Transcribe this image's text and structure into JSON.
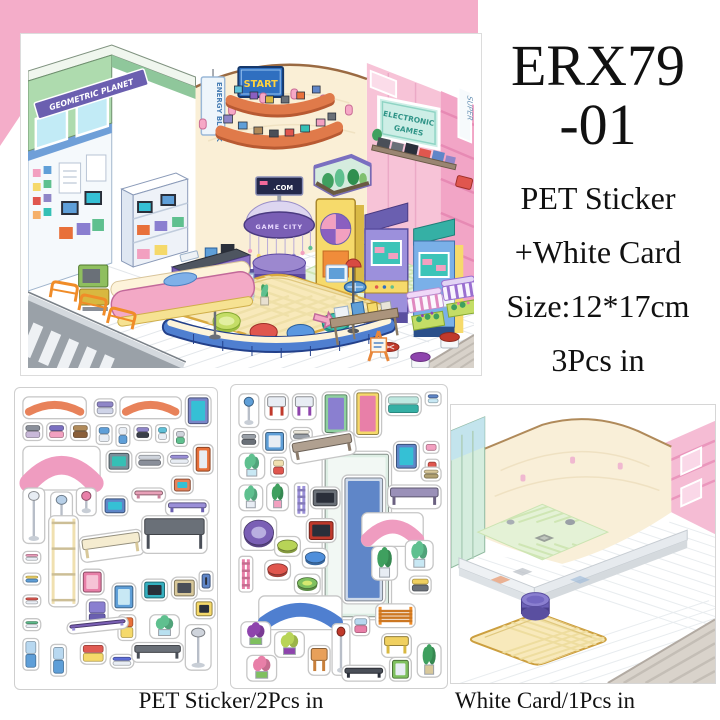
{
  "product": {
    "code_line1": "ERX79",
    "code_line2": "-01",
    "desc_line1": "PET Sticker",
    "desc_line2": "+White Card",
    "desc_line3": "Size:12*17cm",
    "desc_line4": "3Pcs in"
  },
  "captions": {
    "sticker_sheets": "PET Sticker/2Pcs in",
    "white_card": "White Card/1Pcs in"
  },
  "scene_signs": {
    "geometric_planet": "GEOMETRIC PLANET",
    "energy_block": "ENERGY BLOCK",
    "start": "START",
    "electronic": "ELECTRONIC",
    "games": "GAMES",
    "super": "SUPER",
    "game_city": "GAME CITY",
    "com": ".COM"
  },
  "colors": {
    "pink_background": "#f4adc9",
    "wall_cream": "#faefd6",
    "wall_pink": "#f7c3d7",
    "building_green": "#aedbae",
    "shelf_orange": "#e07a4a",
    "carousel_purple": "#7a5fb5",
    "rug_yellow": "#f8e9ba",
    "bench_blue": "#4f7fd0",
    "street_gray": "#9aa1a8"
  },
  "sheet1": {
    "stickers": [
      {
        "n": "curved-shelf",
        "s": "arc",
        "x": 8,
        "y": 8,
        "w": 64,
        "h": 22,
        "c": [
          "#e8825a"
        ]
      },
      {
        "n": "gadget-purple",
        "s": "box",
        "x": 80,
        "y": 10,
        "w": 22,
        "h": 18,
        "c": [
          "#8f86c8",
          "#cfd4e8"
        ]
      },
      {
        "n": "curved-shelf",
        "s": "arc",
        "x": 106,
        "y": 8,
        "w": 62,
        "h": 22,
        "c": [
          "#e8825a"
        ]
      },
      {
        "n": "tv-cart",
        "s": "tv",
        "x": 172,
        "y": 6,
        "w": 26,
        "h": 32,
        "c": [
          "#7a86c8",
          "#35c0d5"
        ]
      },
      {
        "n": "headphones",
        "s": "box",
        "x": 8,
        "y": 34,
        "w": 20,
        "h": 18,
        "c": [
          "#8a8f9a",
          "#c8b8d8"
        ]
      },
      {
        "n": "robot-toy",
        "s": "box",
        "x": 32,
        "y": 34,
        "w": 20,
        "h": 18,
        "c": [
          "#7a6fc0",
          "#f2a0c0"
        ]
      },
      {
        "n": "camera-brown",
        "s": "box",
        "x": 56,
        "y": 34,
        "w": 20,
        "h": 18,
        "c": [
          "#b08a5a",
          "#8a5f3a"
        ]
      },
      {
        "n": "handheld-console",
        "s": "box",
        "x": 82,
        "y": 36,
        "w": 16,
        "h": 20,
        "c": [
          "#5f9fd8",
          "#e8edf4"
        ]
      },
      {
        "n": "flip-phone",
        "s": "box",
        "x": 102,
        "y": 36,
        "w": 14,
        "h": 22,
        "c": [
          "#e8edf4",
          "#5f9fd8"
        ]
      },
      {
        "n": "camera-purple",
        "s": "box",
        "x": 120,
        "y": 36,
        "w": 18,
        "h": 16,
        "c": [
          "#8f86c8",
          "#3a3f4a"
        ]
      },
      {
        "n": "mp3-player",
        "s": "box",
        "x": 142,
        "y": 36,
        "w": 14,
        "h": 18,
        "c": [
          "#5fc0d8",
          "#e8edf4"
        ]
      },
      {
        "n": "gameboy",
        "s": "box",
        "x": 160,
        "y": 40,
        "w": 14,
        "h": 18,
        "c": [
          "#cfd4dc",
          "#5fc08f"
        ]
      },
      {
        "n": "pink-counter",
        "s": "arc",
        "x": 8,
        "y": 58,
        "w": 78,
        "h": 44,
        "c": [
          "#ef9cc0"
        ]
      },
      {
        "n": "game-console",
        "s": "tv",
        "x": 92,
        "y": 62,
        "w": 26,
        "h": 22,
        "c": [
          "#7a8f9a",
          "#35c0b5"
        ]
      },
      {
        "n": "keyboard",
        "s": "box",
        "x": 122,
        "y": 64,
        "w": 28,
        "h": 16,
        "c": [
          "#cfd4dc",
          "#8a8f9a"
        ]
      },
      {
        "n": "gamepad",
        "s": "box",
        "x": 154,
        "y": 64,
        "w": 24,
        "h": 14,
        "c": [
          "#9a8fd8",
          "#e8edf4"
        ]
      },
      {
        "n": "vending-unit",
        "s": "tv",
        "x": 180,
        "y": 56,
        "w": 20,
        "h": 30,
        "c": [
          "#e8703a",
          "#e8edf4"
        ]
      },
      {
        "n": "floor-lamp",
        "s": "lamp",
        "x": 8,
        "y": 100,
        "w": 22,
        "h": 56,
        "c": [
          "#e8edf4"
        ]
      },
      {
        "n": "disco-lamp",
        "s": "lamp",
        "x": 36,
        "y": 104,
        "w": 22,
        "h": 40,
        "c": [
          "#b8d0e8"
        ]
      },
      {
        "n": "mushroom-lamp",
        "s": "lamp",
        "x": 62,
        "y": 100,
        "w": 20,
        "h": 28,
        "c": [
          "#e87fa8"
        ]
      },
      {
        "n": "monitor-blue",
        "s": "tv",
        "x": 88,
        "y": 108,
        "w": 26,
        "h": 20,
        "c": [
          "#5f86c8",
          "#35c0d5"
        ]
      },
      {
        "n": "wall-shelf-pink",
        "s": "table",
        "x": 118,
        "y": 100,
        "w": 34,
        "h": 14,
        "c": [
          "#e8a0b8",
          "#c87f9a"
        ]
      },
      {
        "n": "monitor-orange",
        "s": "tv",
        "x": 158,
        "y": 88,
        "w": 22,
        "h": 18,
        "c": [
          "#e8825a",
          "#35c0d5"
        ]
      },
      {
        "n": "purple-shelf-bar",
        "s": "table",
        "x": 152,
        "y": 112,
        "w": 44,
        "h": 16,
        "c": [
          "#9a8fd8",
          "#6a5fb0"
        ]
      },
      {
        "n": "price-tag",
        "s": "box",
        "x": 8,
        "y": 164,
        "w": 18,
        "h": 12,
        "c": [
          "#f2a0c0",
          "#e8edf4"
        ]
      },
      {
        "n": "price-tag",
        "s": "box",
        "x": 8,
        "y": 186,
        "w": 18,
        "h": 12,
        "c": [
          "#f5d96a",
          "#5f9fd8"
        ]
      },
      {
        "n": "price-tag",
        "s": "box",
        "x": 8,
        "y": 208,
        "w": 18,
        "h": 12,
        "c": [
          "#e05a52",
          "#e8edf4"
        ]
      },
      {
        "n": "price-tag",
        "s": "box",
        "x": 8,
        "y": 232,
        "w": 18,
        "h": 12,
        "c": [
          "#5fc08f",
          "#e8edf4"
        ]
      },
      {
        "n": "ladder-shelf",
        "s": "ladder",
        "x": 34,
        "y": 128,
        "w": 30,
        "h": 92,
        "c": [
          "#f0e0b0"
        ]
      },
      {
        "n": "bench-cream",
        "s": "table",
        "x": 64,
        "y": 150,
        "w": 64,
        "h": 26,
        "c": [
          "#f5ecd0",
          "#d8c89a"
        ],
        "r": -8
      },
      {
        "n": "gray-table",
        "s": "table",
        "x": 128,
        "y": 128,
        "w": 66,
        "h": 38,
        "c": [
          "#6a7078",
          "#4a4f58"
        ]
      },
      {
        "n": "mini-fridge-pink",
        "s": "tv",
        "x": 66,
        "y": 182,
        "w": 24,
        "h": 26,
        "c": [
          "#e87fa8",
          "#f6c3d6"
        ]
      },
      {
        "n": "cabinet-purple",
        "s": "box",
        "x": 72,
        "y": 212,
        "w": 22,
        "h": 30,
        "c": [
          "#8a7fd0",
          "#6a5fb0"
        ]
      },
      {
        "n": "cooler-blue",
        "s": "tv",
        "x": 98,
        "y": 196,
        "w": 24,
        "h": 28,
        "c": [
          "#5f9fd8",
          "#c8e8f4"
        ]
      },
      {
        "n": "locker-orange",
        "s": "box",
        "x": 104,
        "y": 228,
        "w": 18,
        "h": 26,
        "c": [
          "#e8703a",
          "#f5d96a"
        ]
      },
      {
        "n": "tv-teal",
        "s": "tv",
        "x": 128,
        "y": 192,
        "w": 26,
        "h": 22,
        "c": [
          "#35b0c0",
          "#2a2f3a"
        ]
      },
      {
        "n": "console-beige",
        "s": "tv",
        "x": 158,
        "y": 190,
        "w": 26,
        "h": 22,
        "c": [
          "#d8c89a",
          "#4a4f58"
        ]
      },
      {
        "n": "tv-blue-small",
        "s": "tv",
        "x": 186,
        "y": 184,
        "w": 14,
        "h": 20,
        "c": [
          "#5f86c8",
          "#2a2f3a"
        ]
      },
      {
        "n": "tv-yellow",
        "s": "tv",
        "x": 180,
        "y": 212,
        "w": 22,
        "h": 20,
        "c": [
          "#f5d96a",
          "#2a2f3a"
        ]
      },
      {
        "n": "sign-blue",
        "s": "box",
        "x": 8,
        "y": 252,
        "w": 16,
        "h": 32,
        "c": [
          "#b8d8f0",
          "#5f9fd8"
        ]
      },
      {
        "n": "sign-blue",
        "s": "box",
        "x": 36,
        "y": 258,
        "w": 16,
        "h": 32,
        "c": [
          "#b8d8f0",
          "#5f9fd8"
        ]
      },
      {
        "n": "planet-sign",
        "s": "table",
        "x": 52,
        "y": 236,
        "w": 62,
        "h": 12,
        "c": [
          "#7a5fb5",
          "#9a8fd8"
        ],
        "r": -6
      },
      {
        "n": "arcade-controls",
        "s": "box",
        "x": 66,
        "y": 256,
        "w": 26,
        "h": 22,
        "c": [
          "#e05a52",
          "#f5d96a"
        ]
      },
      {
        "n": "gamepad-blue",
        "s": "box",
        "x": 96,
        "y": 268,
        "w": 24,
        "h": 14,
        "c": [
          "#5f6fd8",
          "#e8edf4"
        ]
      },
      {
        "n": "media-shelf",
        "s": "table",
        "x": 118,
        "y": 256,
        "w": 52,
        "h": 20,
        "c": [
          "#6a7078",
          "#4a4f58"
        ]
      },
      {
        "n": "aquarium-small",
        "s": "plant",
        "x": 136,
        "y": 228,
        "w": 30,
        "h": 24,
        "c": [
          "#5fc08f",
          "#b8e0f0"
        ]
      },
      {
        "n": "monitor-stand",
        "s": "lamp",
        "x": 172,
        "y": 238,
        "w": 26,
        "h": 46,
        "c": [
          "#cfd4dc"
        ]
      }
    ]
  },
  "sheet2": {
    "stickers": [
      {
        "n": "glass-wall-panel",
        "s": "tv",
        "x": 92,
        "y": 66,
        "w": 70,
        "h": 170,
        "c": [
          "#ddeee4",
          "#f2f8f4"
        ]
      },
      {
        "n": "display-rack",
        "s": "tv",
        "x": 112,
        "y": 90,
        "w": 44,
        "h": 130,
        "c": [
          "#cdd9ea",
          "#5f86c8"
        ]
      },
      {
        "n": "stool-blue",
        "s": "lamp",
        "x": 8,
        "y": 8,
        "w": 20,
        "h": 34,
        "c": [
          "#5f9fd8"
        ]
      },
      {
        "n": "stool-red",
        "s": "table",
        "x": 34,
        "y": 8,
        "w": 24,
        "h": 26,
        "c": [
          "#e8edf4",
          "#c0392b"
        ]
      },
      {
        "n": "stool-purple",
        "s": "table",
        "x": 62,
        "y": 8,
        "w": 24,
        "h": 26,
        "c": [
          "#e8edf4",
          "#8e44ad"
        ]
      },
      {
        "n": "arcade-green",
        "s": "tv",
        "x": 92,
        "y": 6,
        "w": 28,
        "h": 44,
        "c": [
          "#8fd0a0",
          "#8a7fd0"
        ]
      },
      {
        "n": "arcade-yellow",
        "s": "tv",
        "x": 124,
        "y": 4,
        "w": 28,
        "h": 48,
        "c": [
          "#f5d96a",
          "#e87fa8"
        ]
      },
      {
        "n": "games-sign",
        "s": "box",
        "x": 156,
        "y": 8,
        "w": 36,
        "h": 22,
        "c": [
          "#bfe8e0",
          "#35b0a5"
        ]
      },
      {
        "n": "gadget-blue",
        "s": "box",
        "x": 196,
        "y": 6,
        "w": 16,
        "h": 14,
        "c": [
          "#5f86c8",
          "#c8e8f4"
        ]
      },
      {
        "n": "cap-gray",
        "s": "box",
        "x": 8,
        "y": 46,
        "w": 20,
        "h": 16,
        "c": [
          "#9aa0a8",
          "#6a7078"
        ]
      },
      {
        "n": "cooler-box",
        "s": "tv",
        "x": 32,
        "y": 44,
        "w": 24,
        "h": 24,
        "c": [
          "#5f9fd8",
          "#e8edf4"
        ]
      },
      {
        "n": "newspaper",
        "s": "box",
        "x": 60,
        "y": 42,
        "w": 22,
        "h": 14,
        "c": [
          "#e8e4d8",
          "#9aa0a8"
        ]
      },
      {
        "n": "aquarium-cube",
        "s": "plant",
        "x": 8,
        "y": 68,
        "w": 26,
        "h": 26,
        "c": [
          "#5fc08f",
          "#c8e8f4"
        ]
      },
      {
        "n": "juice-box",
        "s": "box",
        "x": 40,
        "y": 72,
        "w": 16,
        "h": 20,
        "c": [
          "#f0e0b0",
          "#e0564e"
        ]
      },
      {
        "n": "bench-brown",
        "s": "table",
        "x": 58,
        "y": 56,
        "w": 66,
        "h": 24,
        "c": [
          "#b0a090",
          "#8a7a6a"
        ],
        "r": -10
      },
      {
        "n": "arcade-screen-blue",
        "s": "tv",
        "x": 164,
        "y": 56,
        "w": 26,
        "h": 30,
        "c": [
          "#5f86c8",
          "#35c0d5"
        ]
      },
      {
        "n": "tag-pink",
        "s": "box",
        "x": 194,
        "y": 56,
        "w": 16,
        "h": 12,
        "c": [
          "#f2a0c0"
        ]
      },
      {
        "n": "tag-red",
        "s": "box",
        "x": 196,
        "y": 74,
        "w": 14,
        "h": 12,
        "c": [
          "#e0564e"
        ]
      },
      {
        "n": "plant-pot",
        "s": "plant",
        "x": 8,
        "y": 100,
        "w": 24,
        "h": 26,
        "c": [
          "#5fc08f",
          "#e8edf4"
        ]
      },
      {
        "n": "plant-fern",
        "s": "plant",
        "x": 36,
        "y": 98,
        "w": 22,
        "h": 28,
        "c": [
          "#3fa05f",
          "#f2a0c0"
        ]
      },
      {
        "n": "charm-string",
        "s": "ladder",
        "x": 64,
        "y": 98,
        "w": 14,
        "h": 34,
        "c": [
          "#9a8fd8"
        ]
      },
      {
        "n": "tv-dark",
        "s": "tv",
        "x": 80,
        "y": 102,
        "w": 30,
        "h": 22,
        "c": [
          "#6a7078",
          "#2a2f3a"
        ]
      },
      {
        "n": "bench-gray",
        "s": "table",
        "x": 158,
        "y": 100,
        "w": 54,
        "h": 24,
        "c": [
          "#9a90b8",
          "#6a6080"
        ]
      },
      {
        "n": "basket",
        "s": "box",
        "x": 192,
        "y": 82,
        "w": 20,
        "h": 14,
        "c": [
          "#d8c89a",
          "#b0a070"
        ]
      },
      {
        "n": "gamecity-sign",
        "s": "circle",
        "x": 10,
        "y": 132,
        "w": 36,
        "h": 34,
        "c": [
          "#7a5fb5",
          "#b9aee0"
        ]
      },
      {
        "n": "tv-red",
        "s": "tv",
        "x": 76,
        "y": 134,
        "w": 30,
        "h": 24,
        "c": [
          "#c0392b",
          "#2a2f3a"
        ]
      },
      {
        "n": "counter-pink-yellow",
        "s": "arc",
        "x": 132,
        "y": 128,
        "w": 62,
        "h": 34,
        "c": [
          "#ef9cc0"
        ]
      },
      {
        "n": "pouf-green",
        "s": "circle",
        "x": 44,
        "y": 152,
        "w": 26,
        "h": 20,
        "c": [
          "#b8d457"
        ]
      },
      {
        "n": "pouf-blue",
        "s": "circle",
        "x": 72,
        "y": 164,
        "w": 26,
        "h": 20,
        "c": [
          "#4f8fdb"
        ]
      },
      {
        "n": "pouf-red",
        "s": "circle",
        "x": 34,
        "y": 176,
        "w": 26,
        "h": 20,
        "c": [
          "#e0564e"
        ]
      },
      {
        "n": "pouf-lime",
        "s": "circle",
        "x": 64,
        "y": 190,
        "w": 26,
        "h": 20,
        "c": [
          "#7fc05f",
          "#d6e970"
        ]
      },
      {
        "n": "charm-string",
        "s": "ladder",
        "x": 8,
        "y": 172,
        "w": 14,
        "h": 36,
        "c": [
          "#e87fa8"
        ]
      },
      {
        "n": "curved-bench-blue",
        "s": "arc",
        "x": 28,
        "y": 212,
        "w": 84,
        "h": 34,
        "c": [
          "#4f7fd0"
        ]
      },
      {
        "n": "plant-tall",
        "s": "plant",
        "x": 142,
        "y": 162,
        "w": 26,
        "h": 34,
        "c": [
          "#3fa05f",
          "#e8edf4"
        ]
      },
      {
        "n": "aquarium-plant",
        "s": "plant",
        "x": 176,
        "y": 156,
        "w": 28,
        "h": 30,
        "c": [
          "#5fc08f",
          "#c8e8f4"
        ]
      },
      {
        "n": "camera-yellow",
        "s": "box",
        "x": 180,
        "y": 192,
        "w": 22,
        "h": 18,
        "c": [
          "#f0d060",
          "#6a7078"
        ]
      },
      {
        "n": "flower-crate",
        "s": "plant",
        "x": 10,
        "y": 238,
        "w": 30,
        "h": 26,
        "c": [
          "#8e44ad",
          "#7fc05f"
        ]
      },
      {
        "n": "flower-crate",
        "s": "plant",
        "x": 44,
        "y": 248,
        "w": 30,
        "h": 26,
        "c": [
          "#b8d457",
          "#8e44ad"
        ]
      },
      {
        "n": "flower-crate",
        "s": "plant",
        "x": 16,
        "y": 272,
        "w": 30,
        "h": 26,
        "c": [
          "#e87fa8",
          "#7fc05f"
        ]
      },
      {
        "n": "easel-sign",
        "s": "table",
        "x": 78,
        "y": 262,
        "w": 22,
        "h": 30,
        "c": [
          "#e8a05a",
          "#c87f3a"
        ]
      },
      {
        "n": "street-lamp",
        "s": "lamp",
        "x": 102,
        "y": 240,
        "w": 18,
        "h": 52,
        "c": [
          "#c0392b"
        ]
      },
      {
        "n": "hand-sign",
        "s": "box",
        "x": 122,
        "y": 232,
        "w": 18,
        "h": 20,
        "c": [
          "#b8d8f0",
          "#e87fa8"
        ]
      },
      {
        "n": "railing-orange",
        "s": "ladder",
        "x": 146,
        "y": 220,
        "w": 40,
        "h": 24,
        "c": [
          "#f08c28"
        ]
      },
      {
        "n": "cart-yellow",
        "s": "table",
        "x": 152,
        "y": 250,
        "w": 30,
        "h": 24,
        "c": [
          "#f0d060",
          "#d8b840"
        ]
      },
      {
        "n": "street-piece",
        "s": "table",
        "x": 112,
        "y": 282,
        "w": 44,
        "h": 16,
        "c": [
          "#4a4f58",
          "#2a2f3a"
        ]
      },
      {
        "n": "mini-fridge-green",
        "s": "tv",
        "x": 160,
        "y": 274,
        "w": 22,
        "h": 24,
        "c": [
          "#7fc05f",
          "#e8edf4"
        ]
      },
      {
        "n": "aloe-plant",
        "s": "plant",
        "x": 188,
        "y": 260,
        "w": 24,
        "h": 34,
        "c": [
          "#3fa05f",
          "#d8c89a"
        ]
      }
    ]
  }
}
